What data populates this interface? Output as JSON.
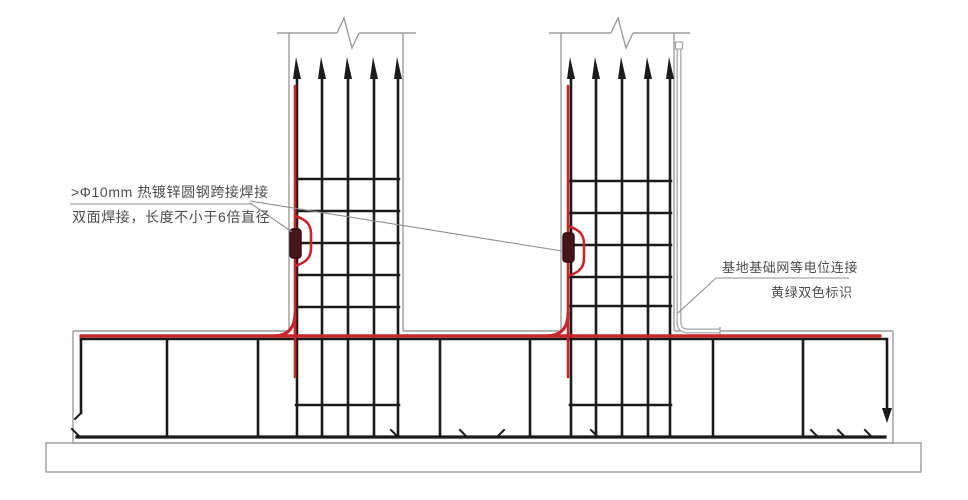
{
  "annotations": {
    "weld_note_line1": ">Φ10mm 热镀锌圆钢跨接焊接",
    "weld_note_line2": "双面焊接，长度不小于6倍直径",
    "bond_note_line1": "基地基础网等电位连接",
    "bond_note_line2": "黄绿双色标识"
  },
  "colors": {
    "conductor_red": "#c7262b",
    "clamp_fill": "#47161a",
    "rebar_black": "#1b1b1b",
    "outline_gray": "#9c9c9c",
    "bonding_gray": "#a6a6a6",
    "leader_gray": "#8e8e8e",
    "text_gray": "#4d4d4d",
    "background": "#ffffff"
  }
}
